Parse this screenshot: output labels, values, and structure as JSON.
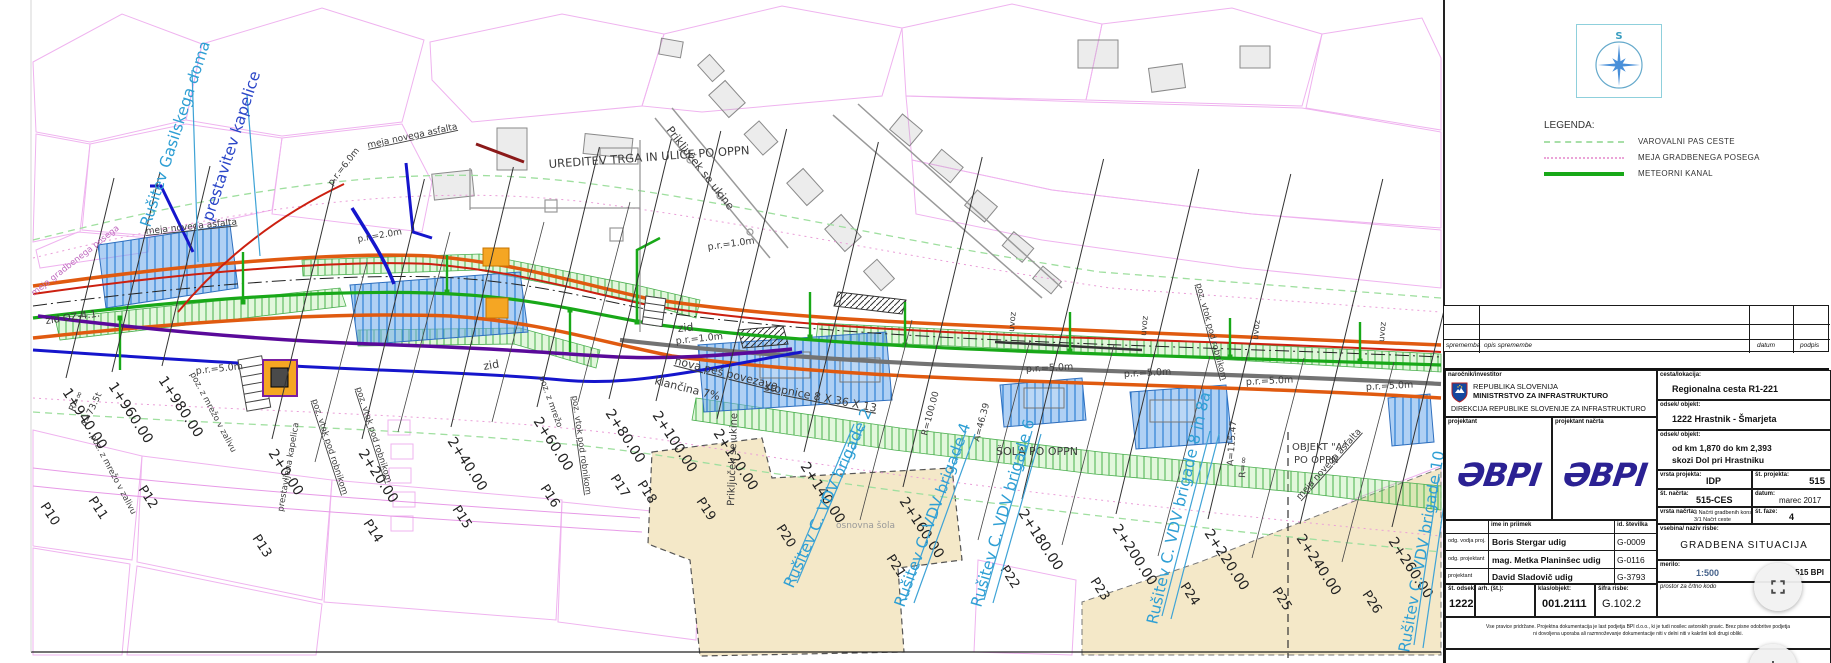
{
  "compass": {
    "north_label": "S"
  },
  "legend": {
    "title": "LEGENDA:",
    "items": [
      {
        "label": "VAROVALNI PAS CESTE",
        "color": "#a8dfa8",
        "style": "dashed"
      },
      {
        "label": "MEJA GRADBENEGA POSEGA",
        "color": "#eba4d8",
        "style": "dotted"
      },
      {
        "label": "METEORNI KANAL",
        "color": "#18a818",
        "style": "solid"
      }
    ]
  },
  "revision": {
    "col_sprememba": "sprememba",
    "col_opis": "opis spremembe",
    "col_datum": "datum",
    "col_podpis": "podpis"
  },
  "tb": {
    "client_label": "naročnik/investitor",
    "client_line1": "REPUBLIKA SLOVENIJA",
    "client_line2": "MINISTRSTVO ZA INFRASTRUKTURO",
    "client_line3": "DIREKCIJA REPUBLIKE SLOVENIJE ZA INFRASTRUKTURO",
    "designer_label": "projektant",
    "designer_plan_label": "projektant načrta",
    "logo_text": "ƏBPI",
    "road_label": "cesta/lokacija:",
    "road": "Regionalna cesta R1-221",
    "section_label": "odsek/ objekt:",
    "section": "1222 Hrastnik - Šmarjeta",
    "subsection_label": "odsek/ objekt:",
    "sub1": "od km 1,870 do km 2,393",
    "sub2": "skozi Dol pri Hrastniku",
    "project_type_label": "vrsta projekta:",
    "project_type": "IDP",
    "project_no_label": "št. projekta:",
    "project_no": "515",
    "plan_no_label": "št. načrta:",
    "plan_no": "515-CES",
    "date_label": "datum:",
    "date": "marec 2017",
    "plan_type_label": "vrsta načrta:",
    "plan_type1": "3 Načrti gradbenih konstrukcij",
    "plan_type2": "3/1 Načrt ceste",
    "phase_label": "št. faze:",
    "phase": "4",
    "people_header_name": "ime in priimek",
    "people_header_id": "id. številka",
    "people": [
      {
        "role": "odg. vodja proj.",
        "name": "Boris Stergar udig",
        "id": "G-0009"
      },
      {
        "role": "odg. projektant",
        "name": "mag. Metka Planinšec udig",
        "id": "G-0116"
      },
      {
        "role": "projektant",
        "name": "David Sladovič udig",
        "id": "G-3793"
      }
    ],
    "title_label": "vsebina/ naziv risbe:",
    "drawing_title": "GRADBENA SITUACIJA",
    "sec_no_label": "št. odseka:",
    "sec_no": "1222",
    "arh_label": "arh. (št.):",
    "klas_label": "klas/objekt:",
    "klas": "001.2111",
    "sheet_label": "šifra risbe:",
    "sheet": "G.102.2",
    "scale_label": "merilo:",
    "scale": "1:500",
    "scale_ref": "515 BPI",
    "barcode_label": "prostor za črtno kodo",
    "disclaimer1": "Vse pravice pridržane. Projektna dokumentacija je last podjetja BPI d.o.o., ki je tudi nosilec avtorskih pravic. Brez pisne odobritve podjetja",
    "disclaimer2": "ni dovoljena uporaba ali razmnoževanje dokumentacije niti v delni niti v kakršni koli drugi obliki."
  },
  "map": {
    "stations": [
      {
        "c": "1+940.00",
        "p": "P10",
        "x": 62,
        "y": 392,
        "px": 40,
        "py": 506,
        "len": 200
      },
      {
        "c": "1+960.00",
        "p": "P11",
        "x": 108,
        "y": 386,
        "px": 88,
        "py": 500,
        "len": 200
      },
      {
        "c": "1+980.00",
        "p": "P12",
        "x": 158,
        "y": 380,
        "px": 138,
        "py": 489,
        "len": 200
      },
      {
        "c": "2+0.00",
        "p": "P13",
        "x": 268,
        "y": 453,
        "px": 252,
        "py": 538,
        "len": 260
      },
      {
        "c": "2+20.00",
        "p": "P14",
        "x": 358,
        "y": 453,
        "px": 363,
        "py": 523,
        "len": 260
      },
      {
        "c": "2+40.00",
        "p": "P15",
        "x": 447,
        "y": 441,
        "px": 452,
        "py": 509,
        "len": 260
      },
      {
        "c": "2+60.00",
        "p": "P16",
        "x": 533,
        "y": 421,
        "px": 540,
        "py": 488,
        "len": 260
      },
      {
        "c": "2+80.00",
        "p": "P17",
        "x": 605,
        "y": 413,
        "px": 610,
        "py": 478,
        "len": 260
      },
      {
        "c": "2+100.00",
        "p": "P18",
        "x": 652,
        "y": 415,
        "px": 637,
        "py": 484,
        "len": 270
      },
      {
        "c": "2+120.00",
        "p": "P19",
        "x": 713,
        "y": 433,
        "px": 696,
        "py": 501,
        "len": 290
      },
      {
        "c": "2+140.00",
        "p": "P20",
        "x": 800,
        "y": 466,
        "px": 776,
        "py": 528,
        "len": 310
      },
      {
        "c": "2+160.00",
        "p": "P21",
        "x": 899,
        "y": 501,
        "px": 886,
        "py": 558,
        "len": 330
      },
      {
        "c": "2+180.00",
        "p": "P22",
        "x": 1018,
        "y": 513,
        "px": 1000,
        "py": 569,
        "len": 340
      },
      {
        "c": "2+200.00",
        "p": "P23",
        "x": 1112,
        "y": 528,
        "px": 1090,
        "py": 581,
        "len": 345
      },
      {
        "c": "2+220.00",
        "p": "P24",
        "x": 1204,
        "y": 533,
        "px": 1180,
        "py": 586,
        "len": 345
      },
      {
        "c": "2+240.00",
        "p": "P25",
        "x": 1296,
        "y": 538,
        "px": 1272,
        "py": 591,
        "len": 345
      },
      {
        "c": "2+260.00",
        "p": "P26",
        "x": 1388,
        "y": 541,
        "px": 1362,
        "py": 594,
        "len": 345
      }
    ],
    "demolitions": [
      {
        "t": "Rušitev Gasilskega doma",
        "x": 150,
        "y": 228,
        "r": -72,
        "c": "#2e9fd4",
        "l": [
          192,
          70,
          198,
          262
        ]
      },
      {
        "t": "prestavitev kapelice",
        "x": 212,
        "y": 222,
        "r": -72,
        "c": "#2b46c8",
        "l": [
          247,
          95,
          260,
          256
        ]
      },
      {
        "t": "Rušitev C. VDV brigade 2",
        "x": 793,
        "y": 589,
        "r": -66,
        "c": "#2e9fd4",
        "l": [
          788,
          580,
          854,
          424
        ],
        "d": 1
      },
      {
        "t": "Rušitev C. VDV brigade 4",
        "x": 904,
        "y": 608,
        "r": -70,
        "c": "#2e9fd4",
        "l": [
          905,
          600,
          966,
          431
        ],
        "d": 1
      },
      {
        "t": "Rušitev C. VDV brigade 6",
        "x": 981,
        "y": 608,
        "r": -74,
        "c": "#2e9fd4",
        "l": [
          984,
          600,
          1032,
          431
        ],
        "d": 1
      },
      {
        "t": "Rušitev C. VDV brigade 8 in 8a",
        "x": 1157,
        "y": 625,
        "r": -77,
        "c": "#2e9fd4",
        "l": [
          1162,
          616,
          1210,
          431
        ],
        "d": 1
      },
      {
        "t": "Rušitev C. VDV brigade 10",
        "x": 1409,
        "y": 653,
        "r": -80,
        "c": "#2e9fd4",
        "l": [
          1414,
          645,
          1439,
          474
        ],
        "d": 1
      }
    ],
    "notes": [
      {
        "t": "UREDITEV TRGA IN ULICE PO OPPN",
        "x": 549,
        "y": 168,
        "r": -4,
        "s": 11.5
      },
      {
        "t": "Priključek se ukine",
        "x": 666,
        "y": 130,
        "r": 52,
        "s": 11
      },
      {
        "t": "Priključek se ukine",
        "x": 734,
        "y": 506,
        "r": -88,
        "s": 10
      },
      {
        "t": "meja novega asfalta",
        "x": 146,
        "y": 234,
        "r": -6,
        "s": 9,
        "u": 1
      },
      {
        "t": "meja novega asfalta",
        "x": 368,
        "y": 148,
        "r": -12,
        "s": 9,
        "u": 1
      },
      {
        "t": "meja novega asfalta",
        "x": 1300,
        "y": 500,
        "r": -48,
        "s": 9,
        "u": 1
      },
      {
        "t": "p.r.=1.0m",
        "x": 708,
        "y": 250,
        "r": -8,
        "s": 9.5
      },
      {
        "t": "p.r.=1.0m",
        "x": 676,
        "y": 344,
        "r": -6,
        "s": 9.5
      },
      {
        "t": "p.r.=5.0m",
        "x": 196,
        "y": 374,
        "r": -6,
        "s": 9.5
      },
      {
        "t": "p.r.=5.0m",
        "x": 1026,
        "y": 372,
        "r": -3,
        "s": 9.5
      },
      {
        "t": "p.r.=5.0m",
        "x": 1124,
        "y": 377,
        "r": -3,
        "s": 9.5
      },
      {
        "t": "p.r.=5.0m",
        "x": 1246,
        "y": 385,
        "r": -3,
        "s": 9.5
      },
      {
        "t": "p.r.=5.0m",
        "x": 1366,
        "y": 390,
        "r": -3,
        "s": 9.5
      },
      {
        "t": "p.r.=6.0m",
        "x": 332,
        "y": 186,
        "r": -52,
        "s": 9
      },
      {
        "t": "p.r.=2.0m",
        "x": 358,
        "y": 242,
        "r": -10,
        "s": 9
      },
      {
        "t": "zid OZ-4.1.",
        "x": 46,
        "y": 324,
        "r": -8,
        "s": 10
      },
      {
        "t": "zid",
        "x": 484,
        "y": 370,
        "r": -10,
        "s": 11
      },
      {
        "t": "zid",
        "x": 678,
        "y": 332,
        "r": -5,
        "s": 11
      },
      {
        "t": "klančina 7%",
        "x": 654,
        "y": 384,
        "r": 14,
        "s": 11
      },
      {
        "t": "nova peš povezava",
        "x": 674,
        "y": 364,
        "r": 14,
        "s": 11,
        "u": 1
      },
      {
        "t": "stopnice 8 X 36 X 13",
        "x": 764,
        "y": 390,
        "r": 11,
        "s": 11,
        "u": 1
      },
      {
        "t": "osnovna šola",
        "x": 836,
        "y": 528,
        "r": 0,
        "s": 9,
        "c": "#999999"
      },
      {
        "t": "ŠOLA PO OPPN",
        "x": 996,
        "y": 455,
        "r": 0,
        "s": 11
      },
      {
        "t": "OBJEKT \"A\"",
        "x": 1292,
        "y": 450,
        "r": 0,
        "s": 10
      },
      {
        "t": "PO OPPN",
        "x": 1294,
        "y": 463,
        "r": 0,
        "s": 10
      },
      {
        "t": "R=∞",
        "x": 74,
        "y": 412,
        "r": -65,
        "s": 9
      },
      {
        "t": "A=73.5t",
        "x": 86,
        "y": 428,
        "r": -65,
        "s": 9
      },
      {
        "t": "R=100.00",
        "x": 927,
        "y": 436,
        "r": -75,
        "s": 9
      },
      {
        "t": "A=46.39",
        "x": 979,
        "y": 442,
        "r": -75,
        "s": 9
      },
      {
        "t": "A=115.47",
        "x": 1233,
        "y": 466,
        "r": -86,
        "s": 9
      },
      {
        "t": "R=∞",
        "x": 1245,
        "y": 478,
        "r": -86,
        "s": 9
      },
      {
        "t": "poz. vtok pod robnikom",
        "x": 312,
        "y": 400,
        "r": 72,
        "s": 8.5,
        "u": 1
      },
      {
        "t": "poz. vtok pod robnikom",
        "x": 356,
        "y": 388,
        "r": 72,
        "s": 8.5,
        "u": 1
      },
      {
        "t": "poz. vtok pod robnikom",
        "x": 572,
        "y": 396,
        "r": 82,
        "s": 8.5,
        "u": 1
      },
      {
        "t": "poz. vtok pod robnikom",
        "x": 1196,
        "y": 284,
        "r": 75,
        "s": 8.5,
        "u": 1
      },
      {
        "t": "poz. z mrežo v zalivu",
        "x": 90,
        "y": 436,
        "r": 62,
        "s": 8.5
      },
      {
        "t": "poz. z mrežo v zalivu",
        "x": 190,
        "y": 374,
        "r": 62,
        "s": 8.5
      },
      {
        "t": "poz. z mrežo",
        "x": 539,
        "y": 377,
        "r": 70,
        "s": 8.5
      },
      {
        "t": "prestavljena kapelica",
        "x": 283,
        "y": 512,
        "r": -80,
        "s": 8.5
      },
      {
        "t": "meja gradbenega posega",
        "x": 34,
        "y": 296,
        "r": -38,
        "s": 8.5,
        "c": "#c06ac0"
      },
      {
        "t": "uvoz",
        "x": 1014,
        "y": 332,
        "r": -85,
        "s": 8.5
      },
      {
        "t": "uvoz",
        "x": 1146,
        "y": 336,
        "r": -85,
        "s": 8.5
      },
      {
        "t": "uvoz",
        "x": 1258,
        "y": 340,
        "r": -85,
        "s": 8.5
      },
      {
        "t": "uvoz",
        "x": 1384,
        "y": 342,
        "r": -85,
        "s": 8.5
      }
    ]
  }
}
